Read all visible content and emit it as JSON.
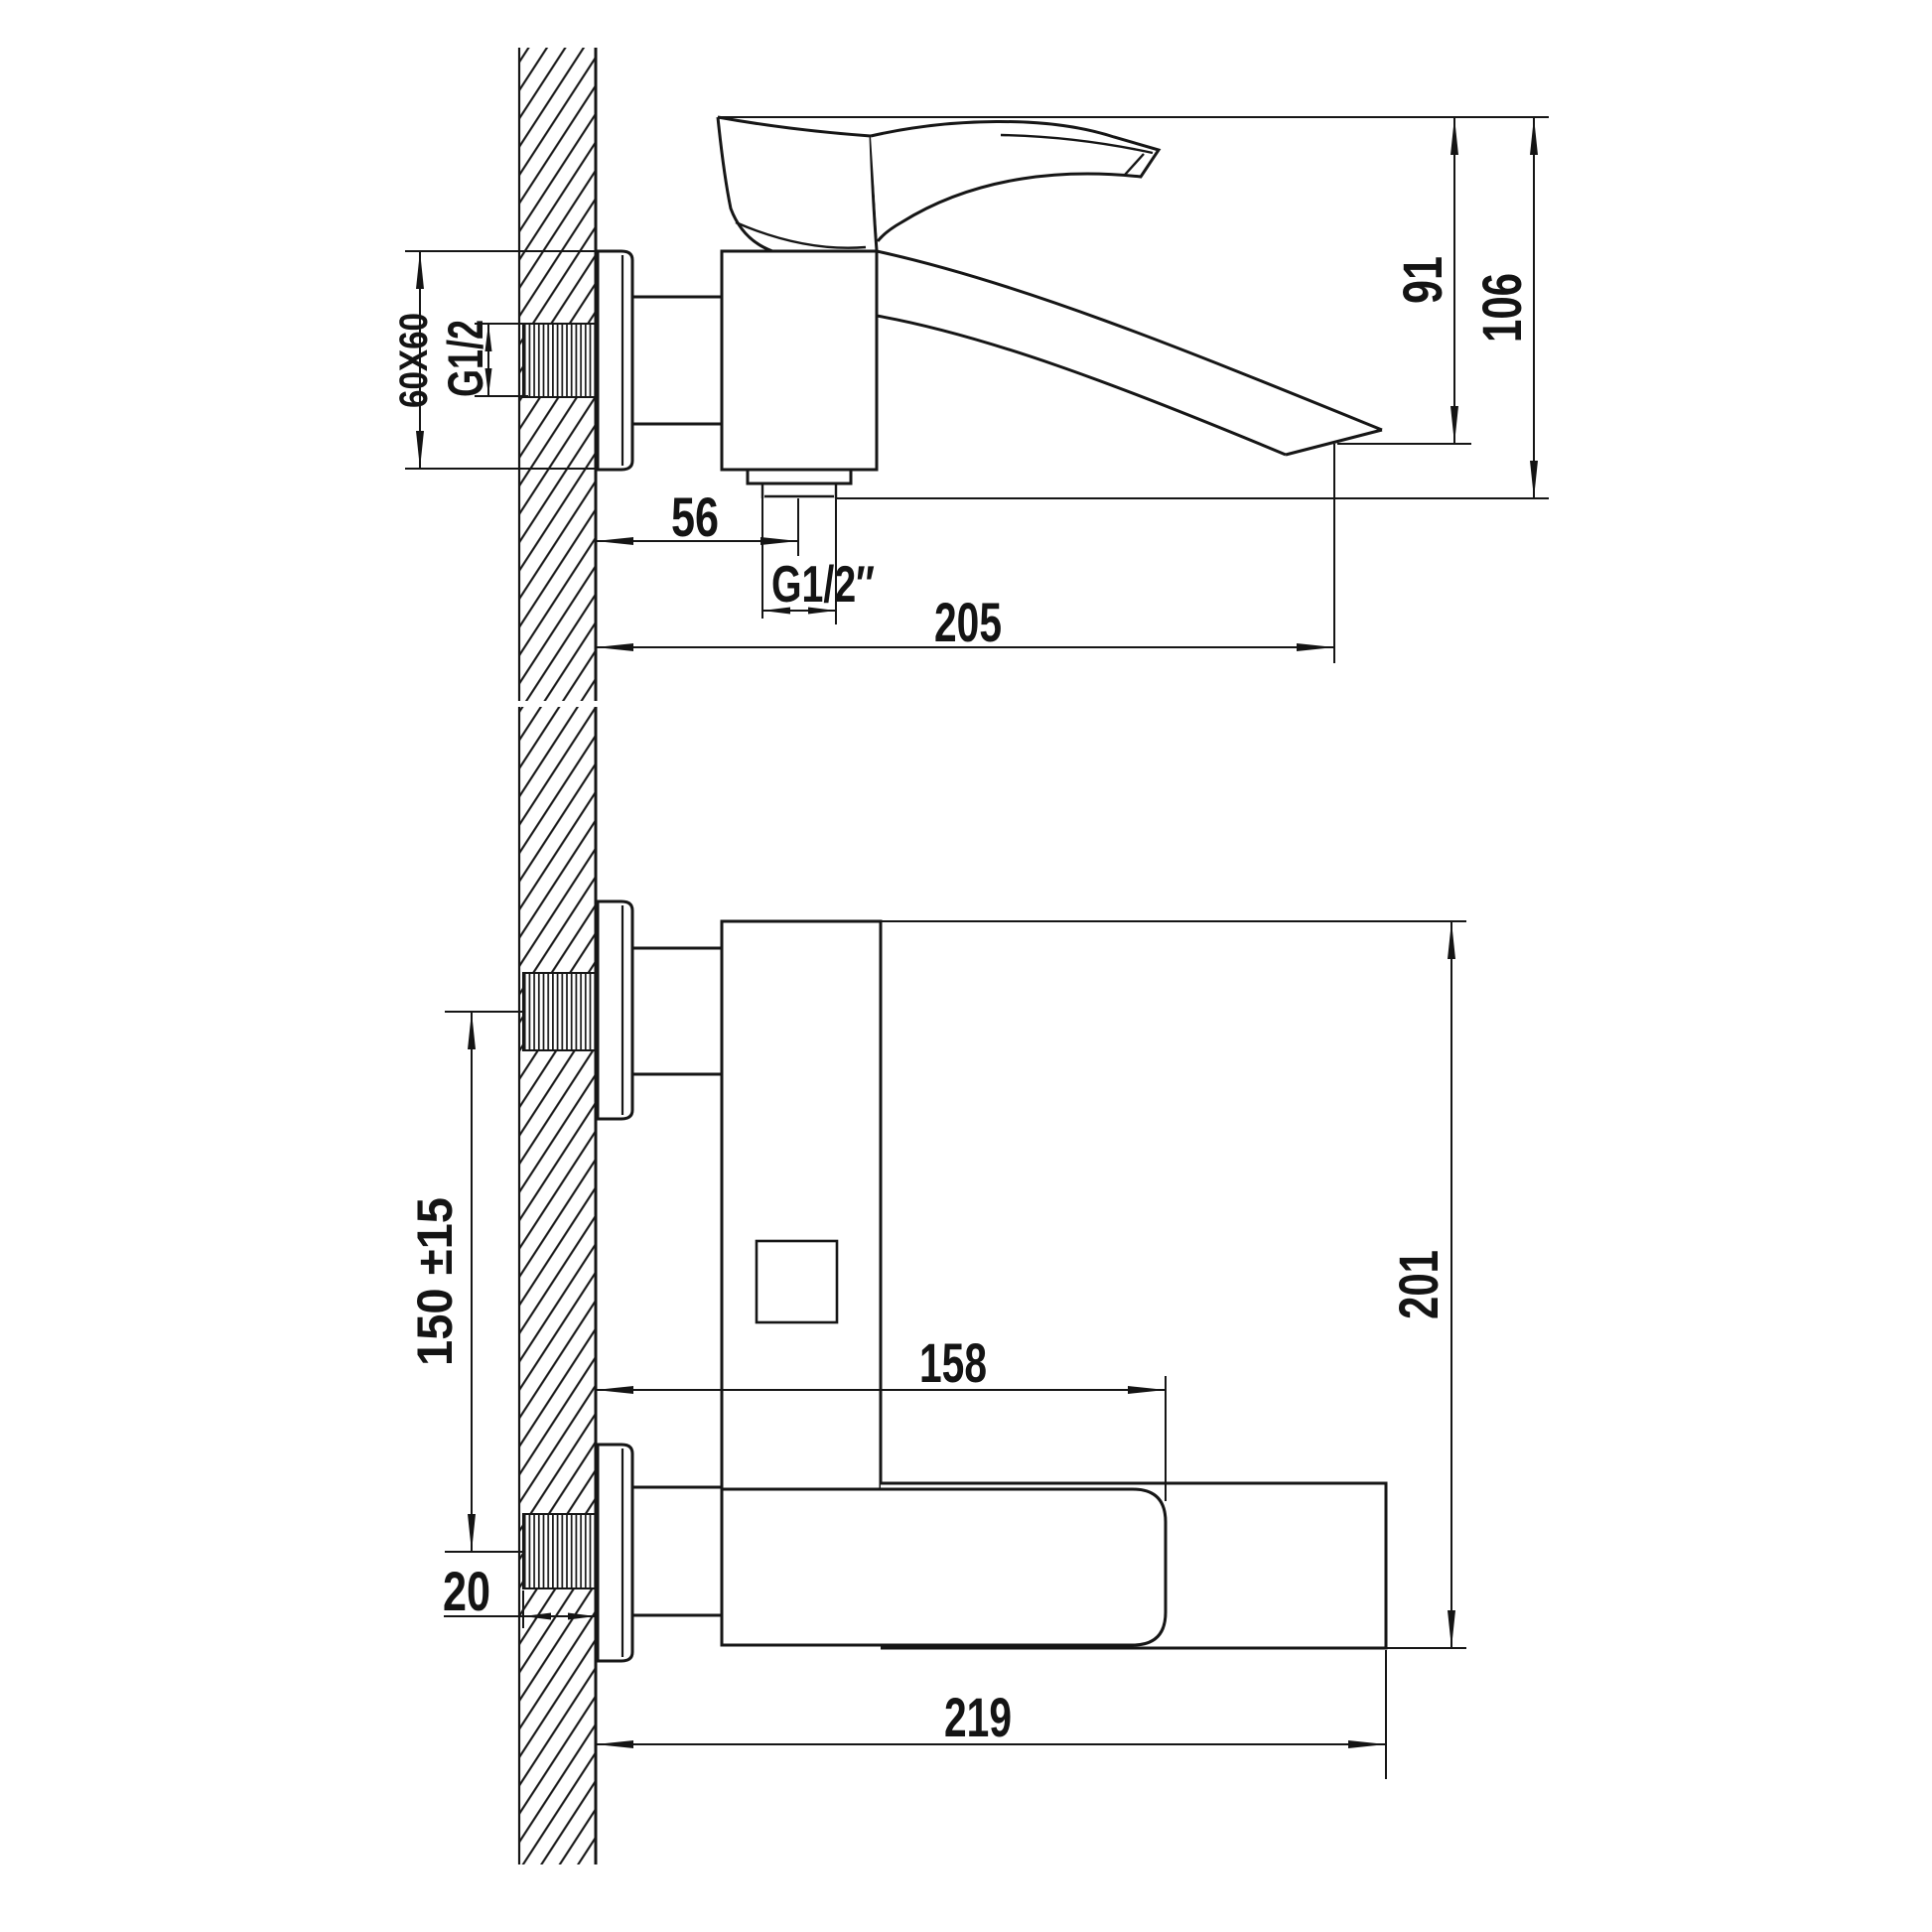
{
  "page": {
    "background": "#ffffff",
    "ink": "#141414"
  },
  "drawing": {
    "subject": "Wall-mounted single-lever bath mixer faucet dimensional drawing",
    "views": {
      "side_view": "side elevation",
      "plan_view": "top plan"
    }
  },
  "side": {
    "flange_size": "60X60",
    "inlet_thread": "G1/2",
    "outlet_offset": "56",
    "outlet_thread": "G1/2″",
    "reach": "205",
    "spout_drop_height": "91",
    "total_height": "106"
  },
  "plan": {
    "inlet_spacing": "150 ±15",
    "thread_length": "20",
    "handle_reach": "158",
    "total_reach": "219",
    "body_length": "201"
  }
}
